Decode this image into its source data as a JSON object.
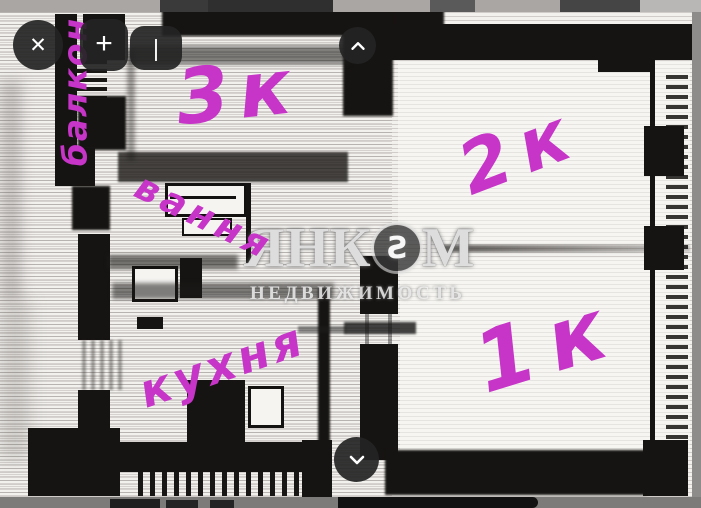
{
  "toolbar": {
    "close_label": "✕",
    "add_label": "+",
    "stroke_label": "|"
  },
  "icons": {
    "close": "x-cross",
    "add": "plus",
    "stroke_width": "vertical-bar",
    "scroll_up": "chevron-up",
    "scroll_down": "chevron-down",
    "logo": "yankom-circle-s"
  },
  "colors": {
    "annotation_ink": "#c634c8",
    "button_bg": "#242424",
    "chrome_gray": "#a9a6a3"
  },
  "watermark": {
    "brand_part1": "ЯНК",
    "logo_letter": "S",
    "brand_part2": "М",
    "subtitle": "НЕДВИЖИМОСТЬ"
  },
  "annotations": {
    "items": [
      {
        "id": "balcony",
        "text": "балкон"
      },
      {
        "id": "room-3",
        "text": "3к"
      },
      {
        "id": "room-2",
        "text": "2к"
      },
      {
        "id": "bath",
        "text": "вання"
      },
      {
        "id": "kitchen",
        "text": "кухня"
      },
      {
        "id": "room-1",
        "text": "1к"
      }
    ]
  }
}
